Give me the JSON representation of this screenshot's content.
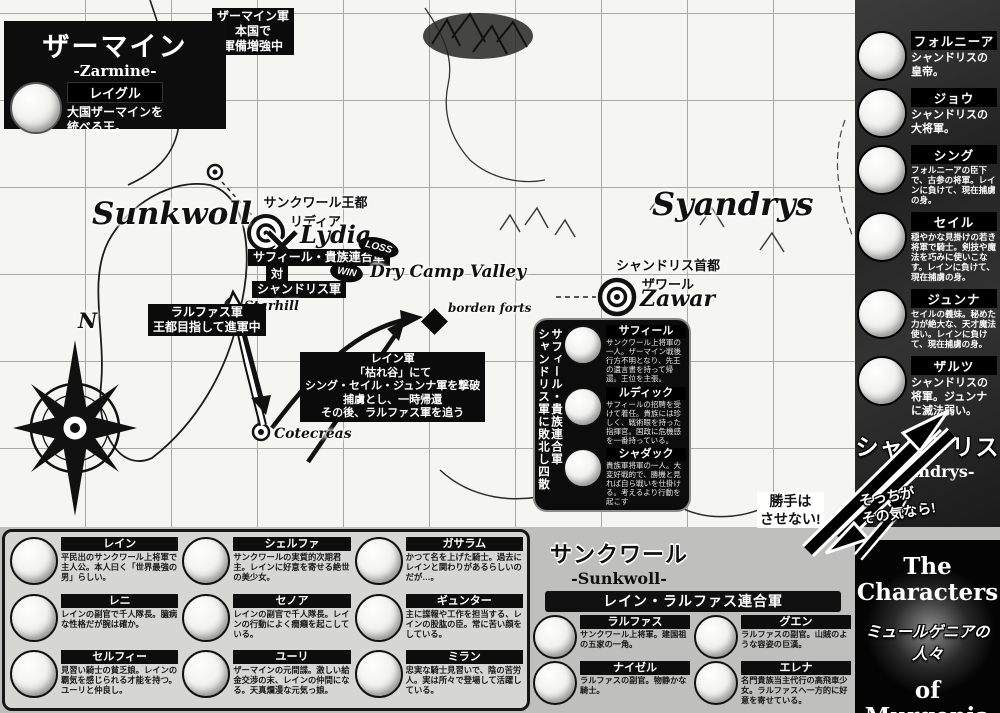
{
  "zarmine": {
    "title": "ザーマイン",
    "subtitle": "-Zarmine-",
    "leader": {
      "name": "レイグル",
      "desc": "大国ザーマインを\n統べる王。"
    },
    "note": "ザーマイン軍\n本国で\n軍備増強中"
  },
  "map": {
    "west_region": "Sunkwoll",
    "east_region": "Syandrys",
    "west_capital_label": "サンクワール王都\nリディア",
    "west_capital_name": "Lydia",
    "east_capital_label": "シャンドリス首都\nザワール",
    "east_capital_name": "Zawar",
    "battle": {
      "side_a": "サフィール・貴族連合軍",
      "badge_a": "LOSS",
      "vs": "対",
      "side_b": "シャンドリス軍",
      "badge_b": "WIN"
    },
    "valley": "Dry Camp Valley",
    "starhill": "Starhill",
    "cotecreas": "Cotecreas",
    "borden_forts": "borden forts",
    "ralphas_note": "ラルファス軍\n王都目指して進軍中",
    "rain_note": "レイン軍\n「枯れ谷」にて\nシング・セイル・ジュンナ軍を撃破\n捕虜とし、一時帰還\nその後、ラルファス軍を追う",
    "compass_n": "N"
  },
  "nobles_box": {
    "vertical_title_line1": "サフィール・貴族連合軍",
    "vertical_title_line2": "シャンドリス軍に敗北し四散",
    "members": [
      {
        "name": "サフィール",
        "desc": "サンクワール上将軍の一人。ザーマイン戦後行方不明となり、先王の遺言書を持って帰還。王位を主張。"
      },
      {
        "name": "ルディック",
        "desc": "サフィールの招聘を受けて着任。貴族には珍しく、戦術眼を持った指揮官。国政に危機感を一番持っている。"
      },
      {
        "name": "シャダック",
        "desc": "貴族軍将軍の一人。大変好戦的で、勝機と見れば自ら戦いを仕掛ける。考えるより行動を起こす"
      }
    ]
  },
  "sunkwoll": {
    "title": "サンクワール",
    "subtitle": "-Sunkwoll-",
    "characters": [
      {
        "name": "レイン",
        "desc": "平民出のサンクワール上将軍で主人公。本人曰く「世界最強の男」らしい。"
      },
      {
        "name": "レニ",
        "desc": "レインの副官で千人隊長。臆病な性格だが腕は確か。"
      },
      {
        "name": "セルフィー",
        "desc": "見習い騎士の貧乏娘。レインの覇気を感じられる才能を持つ。ユーリと仲良し。"
      },
      {
        "name": "シェルファ",
        "desc": "サンクワールの実質的次期君主。レインに好意を寄せる絶世の美少女。"
      },
      {
        "name": "セノア",
        "desc": "レインの副官で千人隊長。レインの行動によく癇癪を起こしている。"
      },
      {
        "name": "ユーリ",
        "desc": "ザーマインの元間諜。激しい給金交渉の末、レインの仲間になる。天真爛漫な元気っ娘。"
      },
      {
        "name": "ガサラム",
        "desc": "かつて名を上げた騎士。過去にレインと関わりがあるらしいのだが…。"
      },
      {
        "name": "ギュンター",
        "desc": "主に諜報や工作を担当する、レインの股肱の臣。常に苦い顔をしている。"
      },
      {
        "name": "ミラン",
        "desc": "忠実な騎士見習いで、陰の苦労人。実は所々で登場して活躍している。"
      }
    ]
  },
  "rain_ralphas": {
    "title": "レイン・ラルファス連合軍",
    "members": [
      {
        "name": "ラルファス",
        "desc": "サンクワール上将軍。建国祖の五家の一角。"
      },
      {
        "name": "グエン",
        "desc": "ラルファスの副官。山賊のような容姿の巨漢。"
      },
      {
        "name": "ナイゼル",
        "desc": "ラルファスの副官。物静かな騎士。"
      },
      {
        "name": "エレナ",
        "desc": "名門貴族当主代行の高飛車少女。ラルファスへ一方的に好意を寄せている。"
      }
    ]
  },
  "syandrys": {
    "title": "シャンドリス",
    "subtitle": "-Syandrys-",
    "characters": [
      {
        "name": "フォルニーア",
        "desc": "シャンドリスの皇帝。"
      },
      {
        "name": "ジョウ",
        "desc": "シャンドリスの大将軍。"
      },
      {
        "name": "シング",
        "desc": "フォルニーアの臣下で、古参の将軍。レインに負けて、現在捕虜の身。"
      },
      {
        "name": "セイル",
        "desc": "穏やかな見掛けの若き将軍で騎士。剣技や魔法を巧みに使いこなす。レインに負けて、現在捕虜の身。"
      },
      {
        "name": "ジュンナ",
        "desc": "セイルの義妹。秘めた力が絶大な、天才魔法使い。レインに負けて、現在捕虜の身。"
      },
      {
        "name": "ザルツ",
        "desc": "シャンドリスの将軍。ジュンナに滅法弱い。"
      }
    ]
  },
  "speech": {
    "left": "勝手は\nさせない!",
    "right": "そっちが\nその気なら!"
  },
  "footer": {
    "en_top": "The\nCharacters",
    "jp": "ミュールゲニアの人々",
    "en_bottom": "of\nMurgenia"
  },
  "colors": {
    "ink": "#0b0b0b",
    "paper": "#f5f5f2",
    "panel": "#d6d6d3",
    "sidebar_dark": "#2a2a2a"
  }
}
